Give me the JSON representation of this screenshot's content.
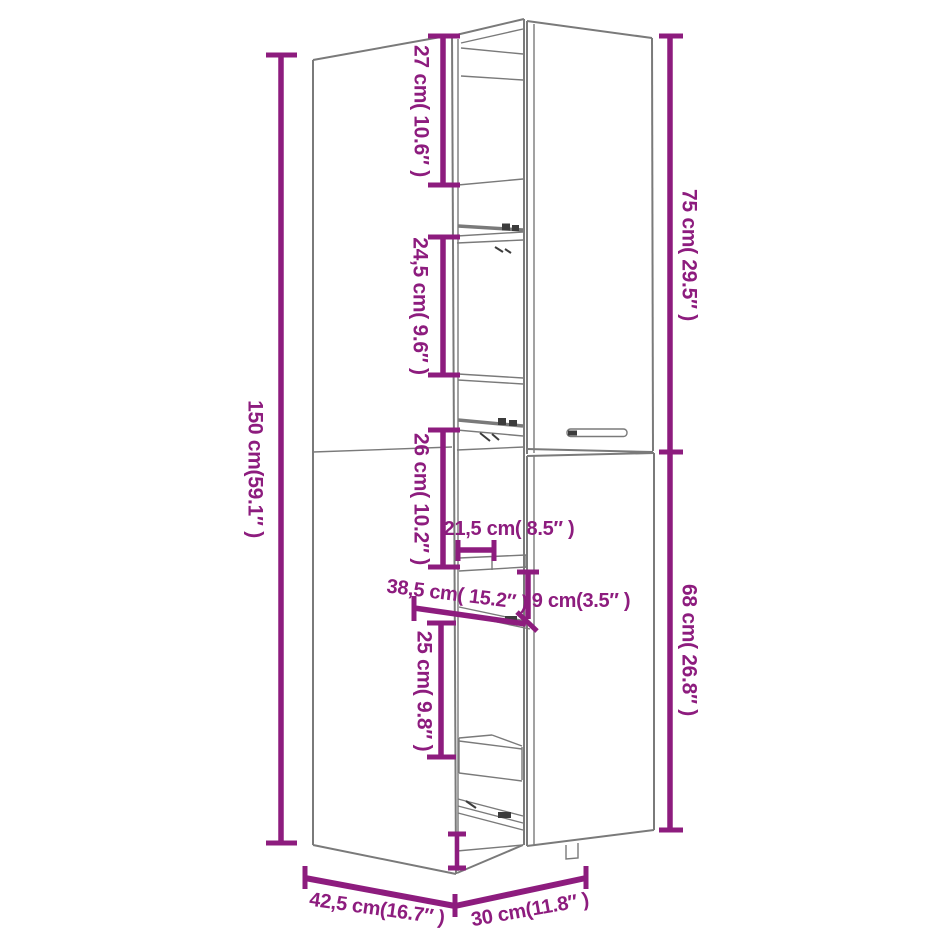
{
  "diagram": {
    "kind": "product-dimension-diagram",
    "subject": "tall pull-out apothecary cabinet line drawing",
    "colors": {
      "dimension": "#8d1c7e",
      "outline": "#7a7a7a",
      "outline_dark": "#3c3c3c",
      "background": "#ffffff"
    },
    "labels": {
      "total_height": "150 cm(59.1″ )",
      "top_compartment": "27 cm( 10.6″ )",
      "second_compartment": "24,5 cm( 9.6″ )",
      "third_compartment": "26 cm( 10.2″ )",
      "fourth_compartment": "25 cm( 9.8″ )",
      "upper_door_height": "75 cm( 29.5″ )",
      "lower_door_height": "68 cm( 26.8″ )",
      "tray_width": "21,5 cm( 8.5″ )",
      "pullout_depth": "38,5 cm( 15.2″ )",
      "tray_height": "9 cm(3.5″ )",
      "base_depth": "42,5 cm(16.7″ )",
      "base_width": "30 cm(11.8″ )"
    }
  }
}
